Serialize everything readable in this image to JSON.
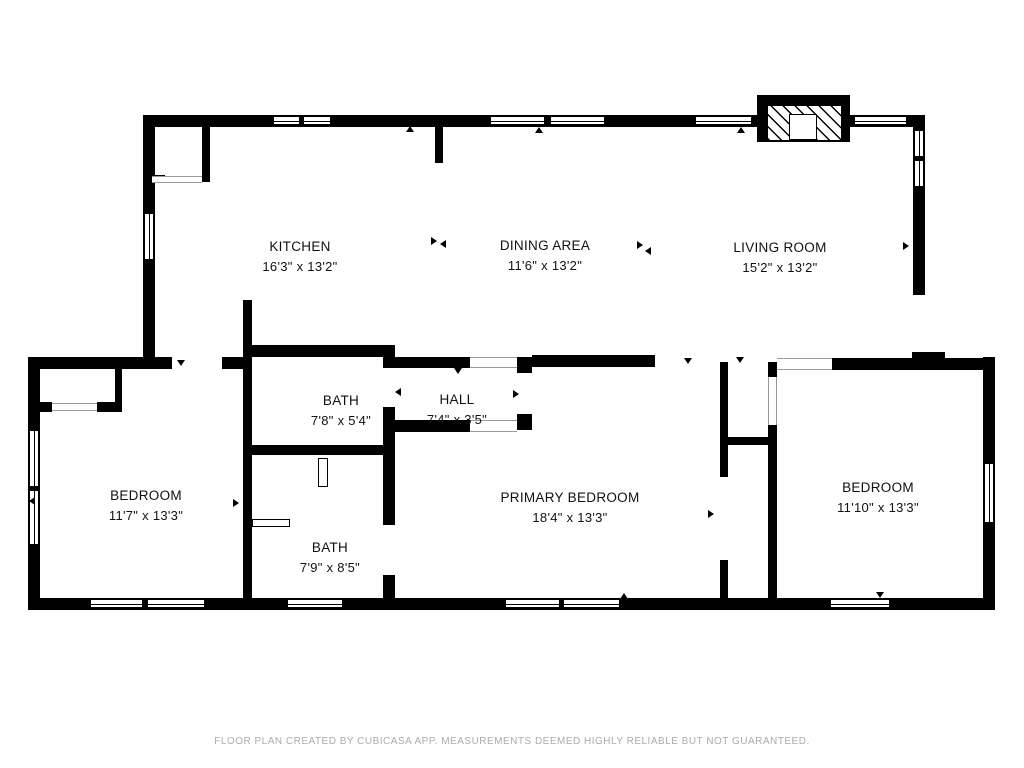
{
  "footer": "FLOOR PLAN CREATED BY CUBICASA APP. MEASUREMENTS DEEMED HIGHLY RELIABLE BUT NOT GUARANTEED.",
  "rooms": {
    "kitchen": {
      "name": "KITCHEN",
      "dims": "16'3\" x 13'2\""
    },
    "dining": {
      "name": "DINING AREA",
      "dims": "11'6\" x 13'2\""
    },
    "living": {
      "name": "LIVING ROOM",
      "dims": "15'2\" x 13'2\""
    },
    "bath_upper": {
      "name": "BATH",
      "dims": "7'8\" x 5'4\""
    },
    "hall": {
      "name": "HALL",
      "dims": "7'4\" x 3'5\""
    },
    "bedroom_left": {
      "name": "BEDROOM",
      "dims": "11'7\" x 13'3\""
    },
    "bath_lower": {
      "name": "BATH",
      "dims": "7'9\" x 8'5\""
    },
    "primary": {
      "name": "PRIMARY BEDROOM",
      "dims": "18'4\" x 13'3\""
    },
    "bedroom_right": {
      "name": "BEDROOM",
      "dims": "11'10\" x 13'3\""
    }
  },
  "colors": {
    "wall": "#000000",
    "label": "#111111",
    "footer": "#ababab"
  }
}
